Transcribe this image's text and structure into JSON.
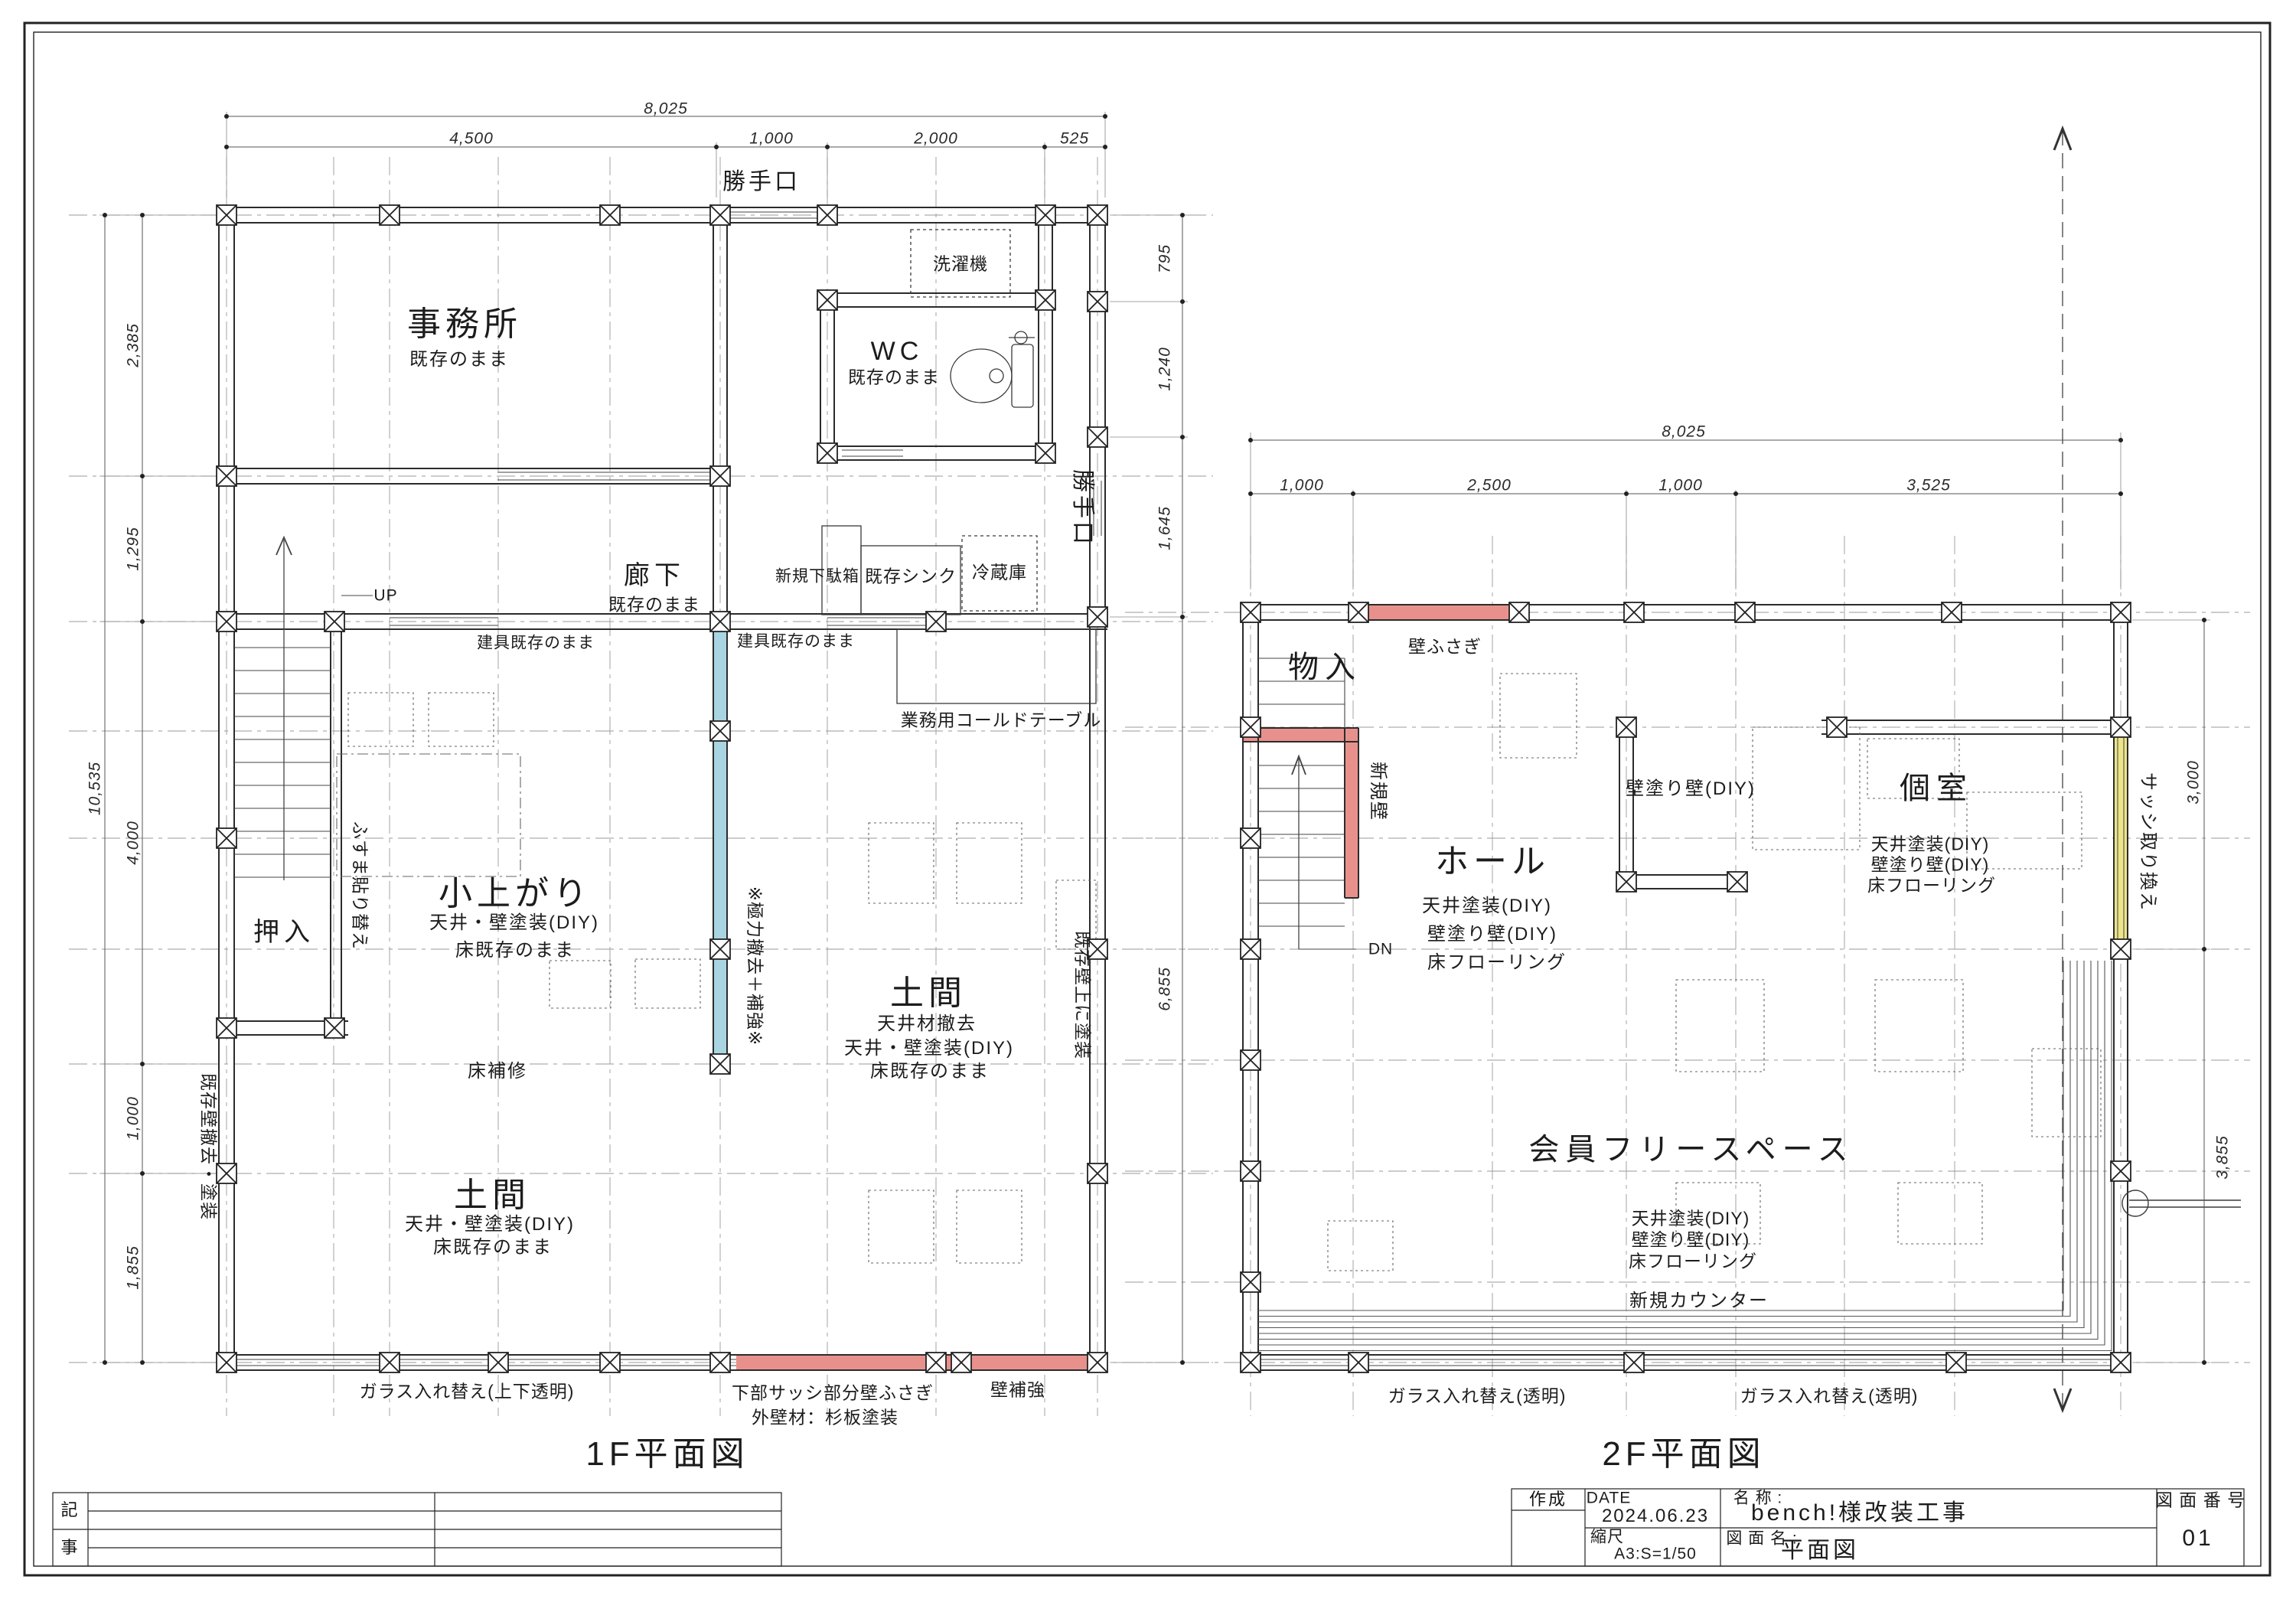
{
  "colors": {
    "highlight_blue": "#a9d4e2",
    "highlight_red": "#e8918c",
    "highlight_yellow": "#ece58a",
    "line": "#2b2b2b",
    "grid": "#9a9a9a"
  },
  "floor1": {
    "title": "1F平面図",
    "dims": {
      "width_total": "8,025",
      "width_segments": [
        "4,500",
        "1,000",
        "2,000",
        "525"
      ],
      "height_total": "10,535",
      "height_segments": [
        "2,385",
        "1,295",
        "4,000",
        "1,000",
        "1,855"
      ],
      "right_segments": [
        "795",
        "1,240",
        "1,645",
        "6,855"
      ]
    },
    "rooms": {
      "office": {
        "name": "事務所",
        "note": "既存のまま"
      },
      "wc": {
        "name": "WC",
        "note": "既存のまま"
      },
      "corridor": {
        "name": "廊下",
        "note": "既存のまま"
      },
      "koagari": {
        "name": "小上がり",
        "notes": [
          "天井・壁塗装(DIY)",
          "床既存のまま"
        ]
      },
      "oshiire": {
        "name": "押入"
      },
      "doma_center": {
        "name": "土間",
        "notes": [
          "天井材撤去",
          "天井・壁塗装(DIY)",
          "床既存のまま"
        ]
      },
      "doma_south": {
        "name": "土間",
        "notes": [
          "天井・壁塗装(DIY)",
          "床既存のまま"
        ]
      }
    },
    "labels": {
      "katteguchi_top": "勝手口",
      "katteguchi_right": "勝手口",
      "washer": "洗濯機",
      "up": "UP",
      "geta_box": "新規下駄箱",
      "sink": "既存シンク",
      "fridge": "冷蔵庫",
      "fittings_1": "建具既存のまま",
      "fittings_2": "建具既存のまま",
      "cold_table": "業務用コールドテーブル",
      "fusuma": "ふすま貼り替え",
      "remove_reinforce": "※極力撤去＋補強※",
      "paint_over": "既存壁上に塗装",
      "floor_repair": "床補修",
      "wall_remove": "既存壁撤去・塗装",
      "glass_replace": "ガラス入れ替え(上下透明)",
      "sash_close": "下部サッシ部分壁ふさぎ",
      "siding": "外壁材：杉板塗装",
      "wall_reinforce": "壁補強"
    }
  },
  "floor2": {
    "title": "2F平面図",
    "dims": {
      "width_total": "8,025",
      "width_segments": [
        "1,000",
        "2,500",
        "1,000",
        "3,525"
      ],
      "right_segments": [
        "3,000",
        "3,855"
      ]
    },
    "rooms": {
      "mono": {
        "name": "物入"
      },
      "hall": {
        "name": "ホール",
        "notes": [
          "天井塗装(DIY)",
          "壁塗り壁(DIY)",
          "床フローリング"
        ]
      },
      "koshitsu": {
        "name": "個室",
        "notes": [
          "天井塗装(DIY)",
          "壁塗り壁(DIY)",
          "床フローリング"
        ]
      },
      "free": {
        "name": "会員フリースペース",
        "notes": [
          "天井塗装(DIY)",
          "壁塗り壁(DIY)",
          "床フローリング"
        ]
      }
    },
    "labels": {
      "wall_close": "壁ふさぎ",
      "new_wall": "新規壁",
      "dn": "DN",
      "wall_paint": "壁塗り壁(DIY)",
      "sash_replace": "サッシ取り換え",
      "new_counter": "新規カウンター",
      "glass_left": "ガラス入れ替え(透明)",
      "glass_right": "ガラス入れ替え(透明)"
    }
  },
  "titleblock": {
    "ki": "記",
    "ji": "事",
    "sakusei": "作成",
    "date_label": "DATE",
    "date": "2024.06.23",
    "scale_label": "縮尺",
    "scale": "A3:S=1/50",
    "name_label": "名 称 :",
    "name": "bench!様改装工事",
    "dwg_label": "図 面 名 :",
    "dwg": "平面図",
    "no_label": "図 面 番 号",
    "no": "01"
  }
}
